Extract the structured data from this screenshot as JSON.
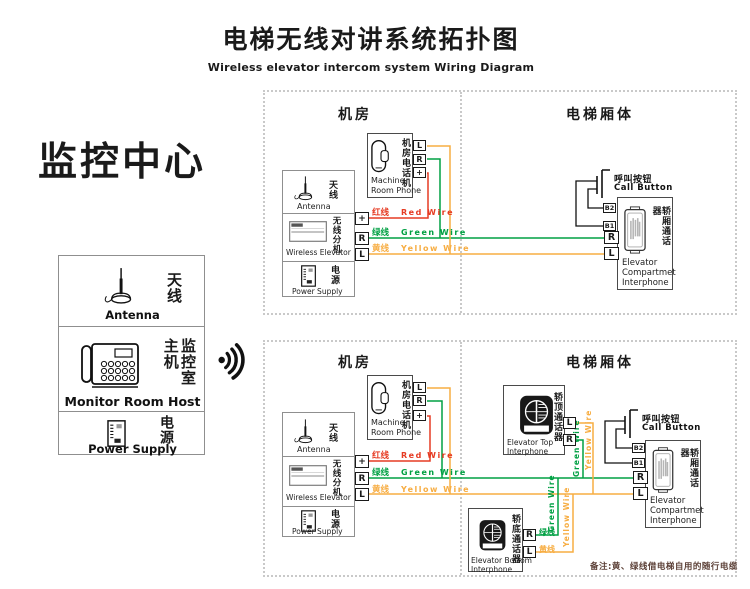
{
  "title": {
    "zh": "电梯无线对讲系统拓扑图",
    "en": "Wireless elevator intercom system Wiring Diagram"
  },
  "monitor": {
    "heading": "监控中心",
    "antenna_zh": "天线",
    "antenna_en": "Antenna",
    "host_zh": "监控室主机",
    "host_en": "Monitor Room Host",
    "power_zh": "电源",
    "power_en": "Power Supply"
  },
  "sections": {
    "machine_room": "机房",
    "car": "电梯厢体"
  },
  "phone": {
    "zh": "机房电话机",
    "en1": "Machine",
    "en2": "Room Phone"
  },
  "unit": {
    "antenna_zh": "天线",
    "antenna_en": "Antenna",
    "zh": "无线分机",
    "en": "Wireless Elevator",
    "power_zh": "电源",
    "power_en": "Power Supply"
  },
  "callbtn": {
    "zh": "呼叫按钮",
    "en": "Call Button"
  },
  "compartment": {
    "zh": "轿厢通话器",
    "en1": "Elevator",
    "en2": "Compartmet",
    "en3": "Interphone"
  },
  "top_unit": {
    "zh": "轿顶通话器",
    "en1": "Elevator Top",
    "en2": "Interphone"
  },
  "bottom_unit": {
    "zh": "轿底通话器",
    "en1": "Elevator Bottom",
    "en2": "Interphone"
  },
  "wires": {
    "red_zh": "红线",
    "red_en": "Red Wire",
    "green_zh": "绿线",
    "green_en": "Green Wire",
    "yellow_zh": "黄线",
    "yellow_en": "Yellow Wire"
  },
  "terminals": {
    "l": "L",
    "r": "R",
    "plus": "+",
    "b1": "B1",
    "b2": "B2"
  },
  "note": "备注:黄、绿线借电梯自用的随行电缆",
  "colors": {
    "red": "#e63b23",
    "green": "#00a043",
    "yellow": "#f7ad42",
    "line_black": "#1a1a1a",
    "border_gray": "#8f8f8f",
    "dash_gray": "#c9c9c9",
    "note_color": "#5c4037"
  }
}
